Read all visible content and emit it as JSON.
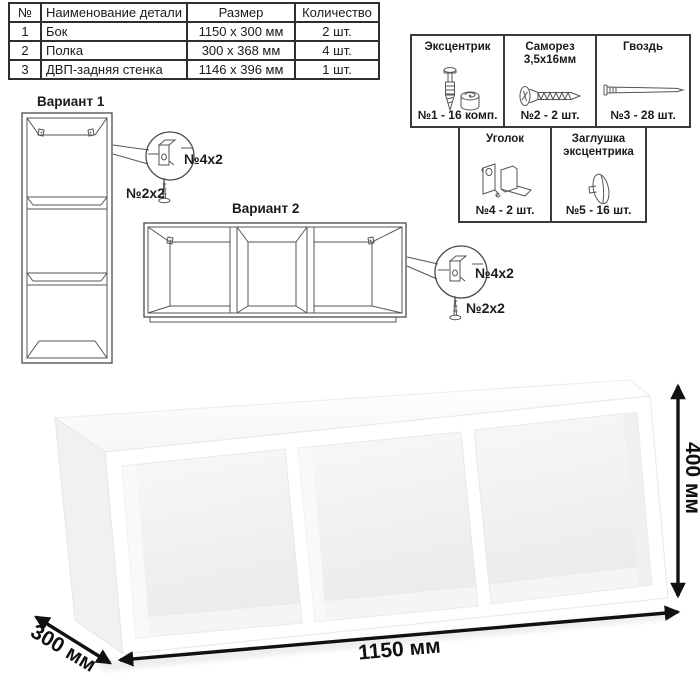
{
  "parts_table": {
    "headers": {
      "num": "№",
      "name": "Наименование детали",
      "size": "Размер",
      "qty": "Количество"
    },
    "rows": [
      {
        "num": "1",
        "name": "Бок",
        "size": "1150 x 300 мм",
        "qty": "2 шт."
      },
      {
        "num": "2",
        "name": "Полка",
        "size": "300 x 368 мм",
        "qty": "4 шт."
      },
      {
        "num": "3",
        "name": "ДВП-задняя стенка",
        "size": "1146 x 396 мм",
        "qty": "1 шт."
      }
    ]
  },
  "hardware": {
    "items": [
      {
        "title": "Эксцентрик",
        "subtitle": "",
        "label": "№1 - 16 комп.",
        "icon": "cam-bolt-icon"
      },
      {
        "title": "Саморез",
        "subtitle": "3,5х16мм",
        "label": "№2 - 2 шт.",
        "icon": "screw-icon"
      },
      {
        "title": "Гвоздь",
        "subtitle": "",
        "label": "№3 - 28 шт.",
        "icon": "nail-icon"
      },
      {
        "title": "Уголок",
        "subtitle": "",
        "label": "№4 - 2 шт.",
        "icon": "corner-bracket-icon"
      },
      {
        "title": "Заглушка эксцентрика",
        "subtitle": "",
        "label": "№5 - 16 шт.",
        "icon": "cam-cap-icon"
      }
    ]
  },
  "variants": {
    "v1": {
      "title": "Вариант 1",
      "bracket_label": "№4х2",
      "screw_label": "№2х2"
    },
    "v2": {
      "title": "Вариант 2",
      "bracket_label": "№4х2",
      "screw_label": "№2х2"
    }
  },
  "dimensions": {
    "width_label": "1150 мм",
    "depth_label": "300 мм",
    "height_label": "400 мм"
  }
}
